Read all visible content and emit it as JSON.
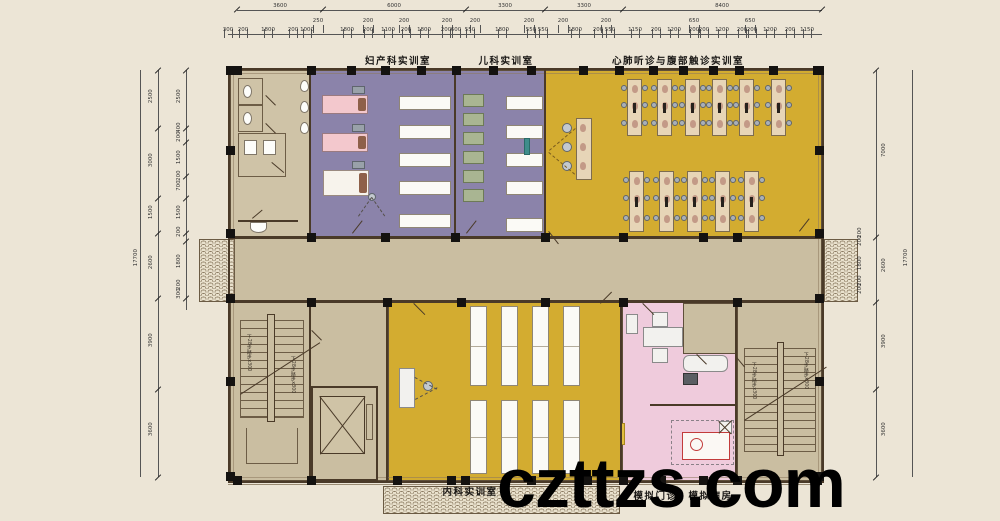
{
  "watermark": {
    "text": "czttzs.com"
  },
  "stair_note": "下28步踏步x300",
  "room_labels": {
    "top": [
      [
        "妇产科实训室",
        398,
        53
      ],
      [
        "儿科实训室",
        506,
        53
      ],
      [
        "心肺听诊与腹部触诊实训室",
        678,
        53
      ]
    ],
    "bottom": [
      [
        "内科实训室",
        470,
        484
      ],
      [
        "模拟门诊、模拟病房",
        683,
        488
      ]
    ]
  },
  "dims": {
    "top": {
      "line1": {
        "y": 10,
        "x1": 237,
        "x2": 822,
        "bounds": [
          237,
          323,
          466,
          545,
          623,
          822
        ],
        "labels": [
          [
            "3600",
            280
          ],
          [
            "6000",
            394
          ],
          [
            "3300",
            505
          ],
          [
            "3300",
            584
          ],
          [
            "8400",
            722
          ]
        ]
      },
      "row2": {
        "y": 16,
        "labels": [
          [
            "250",
            318
          ],
          [
            "200",
            368
          ],
          [
            "200",
            404
          ],
          [
            "200",
            447
          ],
          [
            "200",
            475
          ],
          [
            "200",
            529
          ],
          [
            "200",
            563
          ],
          [
            "200",
            606
          ],
          [
            "650",
            694
          ],
          [
            "650",
            750
          ]
        ]
      },
      "row3": {
        "y": 26,
        "line_y": 34,
        "x1": 228,
        "x2": 822,
        "labels": [
          [
            "300",
            228
          ],
          [
            "200",
            243
          ],
          [
            "1800",
            268
          ],
          [
            "200",
            293
          ],
          [
            "1000",
            307
          ],
          [
            "1800",
            347
          ],
          [
            "200",
            368
          ],
          [
            "1100",
            388
          ],
          [
            "200",
            406
          ],
          [
            "1800",
            424
          ],
          [
            "200",
            446
          ],
          [
            "600",
            456
          ],
          [
            "550",
            470
          ],
          [
            "1800",
            502
          ],
          [
            "550",
            531
          ],
          [
            "550",
            543
          ],
          [
            "1800",
            575
          ],
          [
            "200",
            598
          ],
          [
            "550",
            610
          ],
          [
            "1150",
            635
          ],
          [
            "200",
            656
          ],
          [
            "1200",
            674
          ],
          [
            "200",
            694
          ],
          [
            "200",
            704
          ],
          [
            "1200",
            722
          ],
          [
            "200",
            742
          ],
          [
            "200",
            752
          ],
          [
            "1200",
            770
          ],
          [
            "200",
            790
          ],
          [
            "1150",
            807
          ]
        ]
      }
    },
    "left": {
      "outer_total": [
        "17700",
        131,
        258
      ],
      "outer_line_x": 140,
      "col1": {
        "x": 158,
        "y1": 70,
        "y2": 477,
        "bounds": [
          70,
          128,
          198,
          233,
          298,
          389,
          477
        ],
        "labels": [
          [
            "2500",
            99
          ],
          [
            "3000",
            163
          ],
          [
            "1500",
            215
          ],
          [
            "2600",
            265
          ],
          [
            "3900",
            343
          ],
          [
            "3600",
            432
          ]
        ]
      },
      "col2": {
        "x": 186,
        "y1": 70,
        "y2": 310,
        "bounds": [
          70,
          128,
          142,
          176,
          198,
          233,
          241,
          298
        ],
        "labels": [
          [
            "2500",
            99
          ],
          [
            "400",
            133
          ],
          [
            "200",
            142
          ],
          [
            "1500",
            160
          ],
          [
            "200",
            181
          ],
          [
            "700",
            191
          ],
          [
            "1500",
            215
          ],
          [
            "200",
            237
          ],
          [
            "1800",
            264
          ],
          [
            "200",
            290
          ],
          [
            "300",
            299
          ]
        ]
      }
    },
    "right": {
      "outer_total": [
        "17700",
        901,
        258
      ],
      "outer_line_x": 912,
      "col1": {
        "x": 876,
        "y1": 70,
        "y2": 477,
        "bounds": [
          70,
          237,
          302,
          389,
          477
        ],
        "labels": [
          [
            "7000",
            153
          ],
          [
            "2600",
            268
          ],
          [
            "3900",
            344
          ],
          [
            "3600",
            432
          ]
        ]
      },
      "col2": {
        "x": 852,
        "labels": [
          [
            "200",
            238
          ],
          [
            "200",
            246
          ],
          [
            "1800",
            266
          ],
          [
            "200",
            286
          ],
          [
            "200",
            294
          ]
        ]
      }
    }
  },
  "plan": {
    "rooms": [
      {
        "n": "toilet",
        "x": 230,
        "y": 70,
        "w": 80,
        "h": 167,
        "c": "#cfc3a7"
      },
      {
        "n": "obstetrics",
        "x": 310,
        "y": 70,
        "w": 145,
        "h": 167,
        "c": "#8b83aa"
      },
      {
        "n": "pediatrics",
        "x": 455,
        "y": 70,
        "w": 90,
        "h": 167,
        "c": "#8b83aa"
      },
      {
        "n": "auscultation",
        "x": 545,
        "y": 70,
        "w": 277,
        "h": 167,
        "c": "#d3ac30"
      },
      {
        "n": "corridor",
        "x": 230,
        "y": 237,
        "w": 592,
        "h": 65,
        "c": "#cabea1"
      },
      {
        "n": "stair-left",
        "x": 230,
        "y": 302,
        "w": 80,
        "h": 179,
        "c": "#cabea1"
      },
      {
        "n": "lobby",
        "x": 310,
        "y": 302,
        "w": 78,
        "h": 179,
        "c": "#cabea1"
      },
      {
        "n": "internal-med",
        "x": 388,
        "y": 302,
        "w": 234,
        "h": 179,
        "c": "#d3ac30"
      },
      {
        "n": "sim-clinic",
        "x": 622,
        "y": 302,
        "w": 115,
        "h": 179,
        "c": "#efcbdc"
      },
      {
        "n": "stair-right",
        "x": 737,
        "y": 302,
        "w": 85,
        "h": 179,
        "c": "#cabea1"
      },
      {
        "n": "sim-subroom",
        "x": 683,
        "y": 303,
        "w": 54,
        "h": 51,
        "c": "#cabea1"
      }
    ],
    "outer": {
      "border": [
        228,
        68,
        596,
        415
      ],
      "inner": [
        233,
        73,
        586,
        405
      ]
    },
    "walls": [
      [
        309,
        70,
        2,
        167
      ],
      [
        454,
        70,
        2,
        167
      ],
      [
        544,
        70,
        2,
        167
      ],
      [
        309,
        302,
        2,
        179
      ],
      [
        386,
        302,
        2,
        179
      ],
      [
        620,
        302,
        2,
        179
      ],
      [
        735,
        302,
        2,
        179
      ],
      [
        228,
        236,
        594,
        3
      ],
      [
        228,
        300,
        594,
        3
      ],
      [
        650,
        404,
        87,
        2
      ]
    ],
    "canopies": [
      [
        199,
        239,
        36,
        63
      ],
      [
        824,
        239,
        34,
        63
      ],
      [
        383,
        486,
        237,
        28
      ]
    ],
    "ground": [
      [
        228,
        484,
        594,
        1
      ]
    ],
    "columns": [
      [
        233,
        66
      ],
      [
        307,
        66
      ],
      [
        347,
        66
      ],
      [
        381,
        66
      ],
      [
        417,
        66
      ],
      [
        452,
        66
      ],
      [
        489,
        66
      ],
      [
        527,
        66
      ],
      [
        579,
        66
      ],
      [
        615,
        66
      ],
      [
        649,
        66
      ],
      [
        679,
        66
      ],
      [
        709,
        66
      ],
      [
        735,
        66
      ],
      [
        769,
        66
      ],
      [
        813,
        66
      ],
      [
        233,
        476
      ],
      [
        307,
        476
      ],
      [
        393,
        476
      ],
      [
        447,
        476
      ],
      [
        461,
        476
      ],
      [
        527,
        476
      ],
      [
        583,
        476
      ],
      [
        619,
        476
      ],
      [
        657,
        476
      ],
      [
        699,
        476
      ],
      [
        733,
        476
      ],
      [
        813,
        476
      ],
      [
        226,
        66
      ],
      [
        226,
        146
      ],
      [
        226,
        229
      ],
      [
        226,
        294
      ],
      [
        226,
        377
      ],
      [
        226,
        472
      ],
      [
        815,
        66
      ],
      [
        815,
        146
      ],
      [
        815,
        229
      ],
      [
        815,
        294
      ],
      [
        815,
        377
      ],
      [
        815,
        472
      ],
      [
        307,
        233
      ],
      [
        381,
        233
      ],
      [
        451,
        233
      ],
      [
        541,
        233
      ],
      [
        619,
        233
      ],
      [
        699,
        233
      ],
      [
        733,
        233
      ],
      [
        307,
        298
      ],
      [
        383,
        298
      ],
      [
        457,
        298
      ],
      [
        541,
        298
      ],
      [
        619,
        298
      ],
      [
        733,
        298
      ]
    ],
    "toilet": {
      "rooms": [
        [
          238,
          78,
          25,
          27
        ],
        [
          238,
          105,
          25,
          27
        ],
        [
          238,
          133,
          48,
          44
        ]
      ],
      "toilets": [
        [
          243,
          85,
          9,
          13
        ],
        [
          243,
          112,
          9,
          13
        ]
      ],
      "basins": [
        [
          244,
          140,
          13,
          15
        ],
        [
          263,
          140,
          13,
          15
        ]
      ],
      "urinals": [
        [
          300,
          80,
          9,
          12
        ],
        [
          300,
          101,
          9,
          12
        ],
        [
          300,
          122,
          9,
          12
        ]
      ],
      "mopline": [
        238,
        220,
        60,
        2
      ],
      "mop": [
        250,
        222,
        17,
        11
      ]
    },
    "beds": [
      [
        322,
        95,
        19,
        "bedp"
      ],
      [
        322,
        133,
        19,
        "bedp"
      ],
      [
        323,
        170,
        26,
        "bedw"
      ]
    ],
    "monitors": [
      [
        352,
        86
      ],
      [
        352,
        124
      ],
      [
        352,
        161
      ]
    ],
    "tables": [
      {
        "x": 399,
        "w": 52,
        "h": 14,
        "ys": [
          96,
          125,
          153,
          181,
          214
        ]
      },
      {
        "x": 506,
        "w": 37,
        "h": 14,
        "ys": [
          96,
          125,
          153,
          181,
          218
        ]
      }
    ],
    "incubators": {
      "x": 463,
      "w": 21,
      "h": 13,
      "ys": [
        94,
        113,
        132,
        151,
        170,
        189
      ]
    },
    "teal": [
      524,
      138,
      6,
      17
    ],
    "demo": {
      "table": [
        576,
        118,
        16,
        62
      ],
      "mans": [
        [
          580,
          124
        ],
        [
          580,
          143
        ],
        [
          580,
          162
        ]
      ]
    },
    "circles": [
      [
        567,
        128,
        5
      ],
      [
        567,
        147,
        5
      ],
      [
        567,
        166,
        5
      ],
      [
        372,
        197,
        4
      ],
      [
        428,
        386,
        5
      ]
    ],
    "desks": {
      "row1": {
        "y": 79,
        "w": 15,
        "h": 57,
        "xs": [
          627,
          657,
          685,
          712,
          739,
          771
        ]
      },
      "row2": {
        "y": 171,
        "w": 15,
        "h": 61,
        "xs": [
          629,
          659,
          687,
          715,
          744
        ]
      }
    },
    "bottom_tables": {
      "xs": [
        470,
        501,
        532,
        563
      ],
      "w": 17,
      "rows": [
        {
          "y": 306,
          "h": 80
        },
        {
          "y": 400,
          "h": 74
        }
      ]
    },
    "podium": [
      399,
      368,
      16,
      40
    ],
    "pink": {
      "chair_top": [
        652,
        312,
        16,
        15
      ],
      "desk": [
        643,
        327,
        40,
        20
      ],
      "chair_bottom": [
        652,
        348,
        16,
        15
      ],
      "cabinet": [
        626,
        314,
        12,
        20
      ],
      "couch": [
        683,
        355,
        45,
        17
      ],
      "device": [
        683,
        373,
        15,
        12
      ],
      "curtain": [
        671,
        420,
        63,
        45
      ],
      "xbox": [
        719,
        421,
        13,
        13
      ],
      "bed": [
        682,
        432,
        48,
        28
      ],
      "redc": [
        690,
        438,
        13,
        13
      ],
      "ystrip": [
        620,
        423,
        5,
        22
      ]
    },
    "stairs": [
      {
        "steps": [
          240,
          320,
          64,
          98
        ],
        "rail": [
          267,
          314,
          8,
          108
        ],
        "diag": [
          240,
          394,
          95,
          -33
        ],
        "notes": [
          [
            246,
            334
          ],
          [
            290,
            356
          ]
        ],
        "land": [
          246,
          428,
          52,
          36
        ]
      },
      {
        "steps": [
          744,
          348,
          72,
          104
        ],
        "rail": [
          777,
          342,
          7,
          114
        ],
        "diag": [
          744,
          420,
          98,
          -33
        ],
        "notes": [
          [
            751,
            362
          ],
          [
            803,
            352
          ]
        ],
        "land": null
      }
    ],
    "elevator": {
      "shaft": [
        311,
        386,
        67,
        95
      ],
      "cab": [
        320,
        396,
        45,
        58
      ],
      "panel": [
        366,
        404,
        7,
        36
      ]
    },
    "doors": [
      [
        352,
        233,
        16,
        -52
      ],
      [
        466,
        233,
        16,
        -52
      ],
      [
        549,
        231,
        16,
        52
      ],
      [
        799,
        231,
        16,
        -52
      ],
      [
        414,
        303,
        16,
        45
      ],
      [
        600,
        303,
        16,
        -45
      ],
      [
        643,
        303,
        16,
        45
      ],
      [
        697,
        354,
        14,
        45
      ],
      [
        266,
        95,
        14,
        45
      ],
      [
        266,
        123,
        14,
        45
      ],
      [
        272,
        162,
        16,
        40
      ],
      [
        252,
        218,
        13,
        -40
      ],
      [
        736,
        356,
        14,
        50
      ],
      [
        312,
        330,
        14,
        45
      ]
    ],
    "dashes": [
      [
        549,
        150,
        34,
        -40,
        "dashy"
      ],
      [
        549,
        152,
        34,
        40,
        "dashy"
      ],
      [
        358,
        216,
        23,
        -55,
        "dashg"
      ],
      [
        372,
        197,
        23,
        55,
        "dashg"
      ],
      [
        415,
        377,
        25,
        28,
        "dashg"
      ],
      [
        415,
        399,
        25,
        -28,
        "dashg"
      ]
    ]
  }
}
